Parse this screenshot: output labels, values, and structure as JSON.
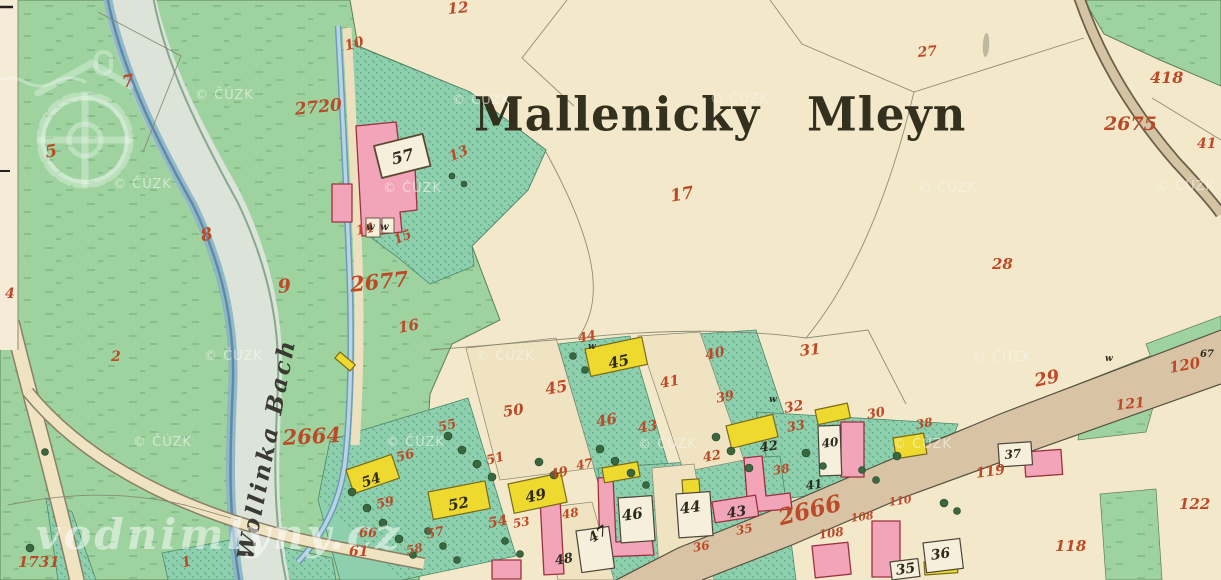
{
  "map": {
    "title": "Mallenicky Mleyn",
    "river_label": "Wollinka Bach",
    "watermark_text": "© ČÚZK",
    "brand_watermark": "vodnimlyny.cz",
    "colors": {
      "parchment": "#f3e8ca",
      "cream": "#efe3c1",
      "margin": "#f4ecd6",
      "green": "#9ed3a0",
      "teal": "#8ed0ad",
      "river": "#dce4d9",
      "riverEdge": "#86b0c6",
      "road": "#d8c3a4",
      "pink": "#f2a4b8",
      "pinkStroke": "#9c3140",
      "yellow": "#eed92f",
      "yellowStroke": "#7a6a1a",
      "white": "#f6efdc",
      "red": "#bc4a28",
      "ink": "#2d2a1e"
    },
    "watermark_positions": [
      [
        195,
        88
      ],
      [
        452,
        93
      ],
      [
        710,
        92
      ],
      [
        113,
        177
      ],
      [
        383,
        181
      ],
      [
        918,
        181
      ],
      [
        1156,
        179
      ],
      [
        204,
        349
      ],
      [
        476,
        349
      ],
      [
        973,
        350
      ],
      [
        133,
        435
      ],
      [
        386,
        435
      ],
      [
        638,
        437
      ],
      [
        893,
        437
      ]
    ],
    "labels": [
      [
        "12",
        447,
        2,
        15,
        "r",
        -5
      ],
      [
        "10",
        343,
        40,
        14,
        "r",
        -15
      ],
      [
        "27",
        917,
        46,
        14,
        "r",
        -5
      ],
      [
        "2720",
        294,
        102,
        17,
        "r",
        -6
      ],
      [
        "418",
        1150,
        70,
        16,
        "r",
        0
      ],
      [
        "2675",
        1104,
        115,
        19,
        "r",
        0
      ],
      [
        "41",
        1197,
        137,
        14,
        "r",
        0
      ],
      [
        "7",
        121,
        75,
        17,
        "r",
        -10
      ],
      [
        "5",
        44,
        145,
        17,
        "r",
        -10
      ],
      [
        "13",
        447,
        151,
        14,
        "r",
        -22
      ],
      [
        "17",
        669,
        189,
        17,
        "r",
        -10
      ],
      [
        "8",
        199,
        229,
        17,
        "r",
        -15
      ],
      [
        "28",
        992,
        257,
        15,
        "r",
        0
      ],
      [
        "9",
        277,
        278,
        19,
        "r",
        -5
      ],
      [
        "2677",
        349,
        274,
        21,
        "r",
        -6
      ],
      [
        "16",
        397,
        321,
        15,
        "r",
        -10
      ],
      [
        "4",
        5,
        287,
        14,
        "r",
        0
      ],
      [
        "2",
        111,
        350,
        14,
        "r",
        0
      ],
      [
        "44",
        577,
        333,
        13,
        "r",
        -12
      ],
      [
        "45",
        544,
        382,
        16,
        "r",
        -10
      ],
      [
        "40",
        704,
        349,
        14,
        "r",
        -12
      ],
      [
        "41",
        659,
        377,
        14,
        "r",
        -10
      ],
      [
        "31",
        799,
        344,
        15,
        "r",
        -6
      ],
      [
        "39",
        715,
        393,
        13,
        "r",
        -12
      ],
      [
        "29",
        1033,
        373,
        18,
        "r",
        -12
      ],
      [
        "120",
        1168,
        361,
        15,
        "r",
        -10
      ],
      [
        "121",
        1115,
        399,
        14,
        "r",
        -6
      ],
      [
        "50",
        502,
        405,
        15,
        "r",
        -8
      ],
      [
        "46",
        595,
        415,
        15,
        "r",
        -10
      ],
      [
        "43",
        637,
        422,
        14,
        "r",
        -10
      ],
      [
        "32",
        783,
        402,
        14,
        "r",
        -10
      ],
      [
        "33",
        786,
        422,
        13,
        "r",
        -10
      ],
      [
        "30",
        866,
        409,
        13,
        "r",
        -10
      ],
      [
        "38",
        915,
        419,
        12,
        "r",
        -10
      ],
      [
        "2664",
        282,
        427,
        21,
        "r",
        -3
      ],
      [
        "55",
        437,
        422,
        13,
        "r",
        -14
      ],
      [
        "56",
        395,
        452,
        13,
        "r",
        -14
      ],
      [
        "51",
        485,
        455,
        13,
        "r",
        -14
      ],
      [
        "42",
        702,
        452,
        13,
        "r",
        -10
      ],
      [
        "119",
        975,
        467,
        14,
        "r",
        -8
      ],
      [
        "122",
        1179,
        497,
        15,
        "r",
        0
      ],
      [
        "54",
        487,
        517,
        14,
        "r",
        -10
      ],
      [
        "49",
        549,
        469,
        13,
        "r",
        -12
      ],
      [
        "47",
        575,
        460,
        12,
        "r",
        -12
      ],
      [
        "53",
        512,
        518,
        12,
        "r",
        -10
      ],
      [
        "48",
        561,
        509,
        12,
        "r",
        -10
      ],
      [
        "59",
        375,
        499,
        13,
        "r",
        -12
      ],
      [
        "66",
        359,
        527,
        13,
        "r",
        0
      ],
      [
        "61",
        349,
        545,
        14,
        "r",
        0
      ],
      [
        "57",
        425,
        529,
        13,
        "r",
        -12
      ],
      [
        "58",
        405,
        545,
        12,
        "r",
        -12
      ],
      [
        "38",
        772,
        465,
        12,
        "r",
        -10
      ],
      [
        "2666",
        776,
        507,
        23,
        "r",
        -14
      ],
      [
        "110",
        888,
        497,
        11,
        "r",
        -8
      ],
      [
        "108",
        850,
        513,
        11,
        "r",
        -8
      ],
      [
        "108",
        818,
        529,
        12,
        "r",
        -8
      ],
      [
        "118",
        1055,
        539,
        15,
        "r",
        0
      ],
      [
        "1731",
        18,
        555,
        15,
        "r",
        0
      ],
      [
        "1",
        180,
        557,
        14,
        "r",
        -15
      ],
      [
        "35",
        735,
        525,
        12,
        "r",
        -10
      ],
      [
        "36",
        692,
        542,
        12,
        "r",
        -10
      ],
      [
        "14",
        355,
        225,
        13,
        "r",
        -10
      ],
      [
        "15",
        392,
        235,
        13,
        "r",
        -22
      ],
      [
        "57",
        390,
        152,
        16,
        "k",
        -14
      ],
      [
        "45",
        607,
        357,
        15,
        "k",
        -12
      ],
      [
        "52",
        447,
        499,
        15,
        "k",
        -11
      ],
      [
        "49",
        524,
        491,
        15,
        "k",
        -12
      ],
      [
        "54",
        360,
        477,
        14,
        "k",
        -18
      ],
      [
        "46",
        621,
        509,
        15,
        "k",
        -8
      ],
      [
        "44",
        679,
        502,
        15,
        "k",
        -8
      ],
      [
        "43",
        726,
        507,
        14,
        "k",
        -8
      ],
      [
        "47",
        586,
        534,
        14,
        "k",
        -32
      ],
      [
        "48",
        554,
        555,
        13,
        "k",
        -10
      ],
      [
        "42",
        759,
        442,
        13,
        "k",
        -8
      ],
      [
        "41",
        805,
        480,
        12,
        "k",
        -8
      ],
      [
        "40",
        821,
        438,
        12,
        "k",
        -8
      ],
      [
        "36",
        930,
        549,
        14,
        "k",
        -8
      ],
      [
        "35",
        895,
        564,
        14,
        "k",
        -8
      ],
      [
        "37",
        1004,
        449,
        12,
        "k",
        -6
      ],
      [
        "67",
        1200,
        350,
        10,
        "k",
        0
      ],
      [
        "w",
        588,
        343,
        9,
        "k",
        0
      ],
      [
        "w",
        769,
        396,
        9,
        "k",
        0
      ],
      [
        "w",
        1105,
        355,
        9,
        "k",
        0
      ],
      [
        "w",
        366,
        223,
        10,
        "k",
        0
      ],
      [
        "w",
        380,
        223,
        10,
        "k",
        0
      ]
    ]
  }
}
